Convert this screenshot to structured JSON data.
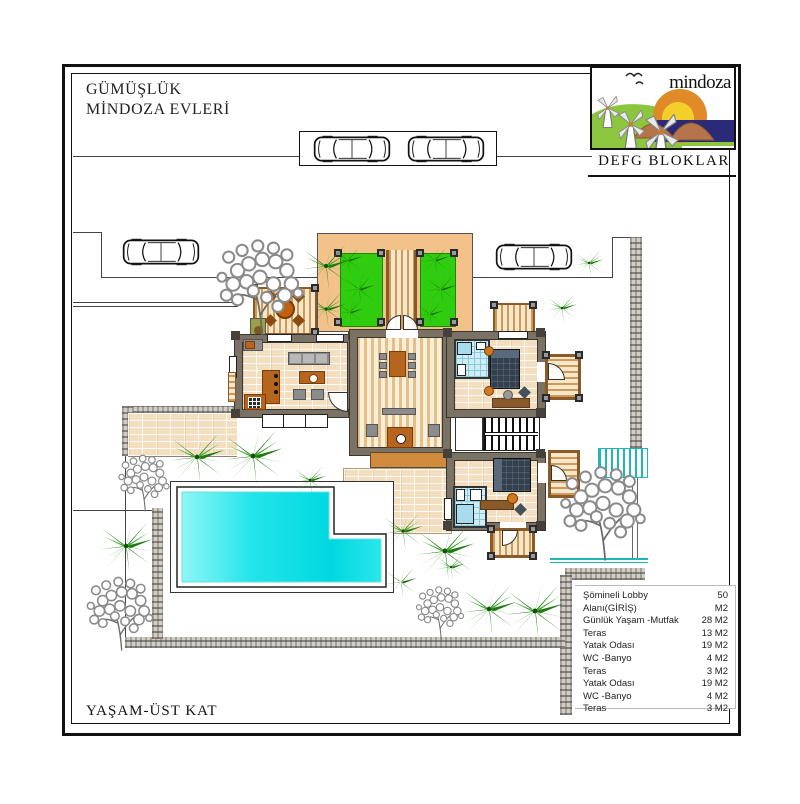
{
  "header": {
    "project_line1": "GÜMÜŞLÜK",
    "project_line2": "MİNDOZA EVLERİ",
    "logo_text": "mindoza",
    "block_label": "DEFG BLOKLAR"
  },
  "footer": {
    "floor_label": "YAŞAM-ÜST KAT"
  },
  "legend": {
    "rows": [
      {
        "label": "Şömineli Lobby Alanı(GİRİŞ)",
        "area": "50 M2"
      },
      {
        "label": "Günlük Yaşam -Mutfak",
        "area": "28 M2"
      },
      {
        "label": "Teras",
        "area": "13 M2"
      },
      {
        "label": "Yatak Odası",
        "area": "19 M2"
      },
      {
        "label": "WC -Banyo",
        "area": "4 M2"
      },
      {
        "label": "Teras",
        "area": "3 M2"
      },
      {
        "label": "Yatak Odası",
        "area": "19 M2"
      },
      {
        "label": "WC -Banyo",
        "area": "4 M2"
      },
      {
        "label": "Teras",
        "area": "3 M2"
      }
    ]
  },
  "colors": {
    "courtyard_orange": "#f2c28a",
    "grass_green": "#2fcc0f",
    "palm_dark": "#156b00",
    "palm_mid": "#2d8a1e",
    "pool_cyan": "#19e2e8",
    "wood_brown": "#cf9a56",
    "wall_gray": "#7b7266",
    "sea_navy": "#2a2a78",
    "sun_orange": "#e08a28",
    "sun_yellow": "#f2cf2a",
    "teal_stair": "#1fb6b6"
  }
}
